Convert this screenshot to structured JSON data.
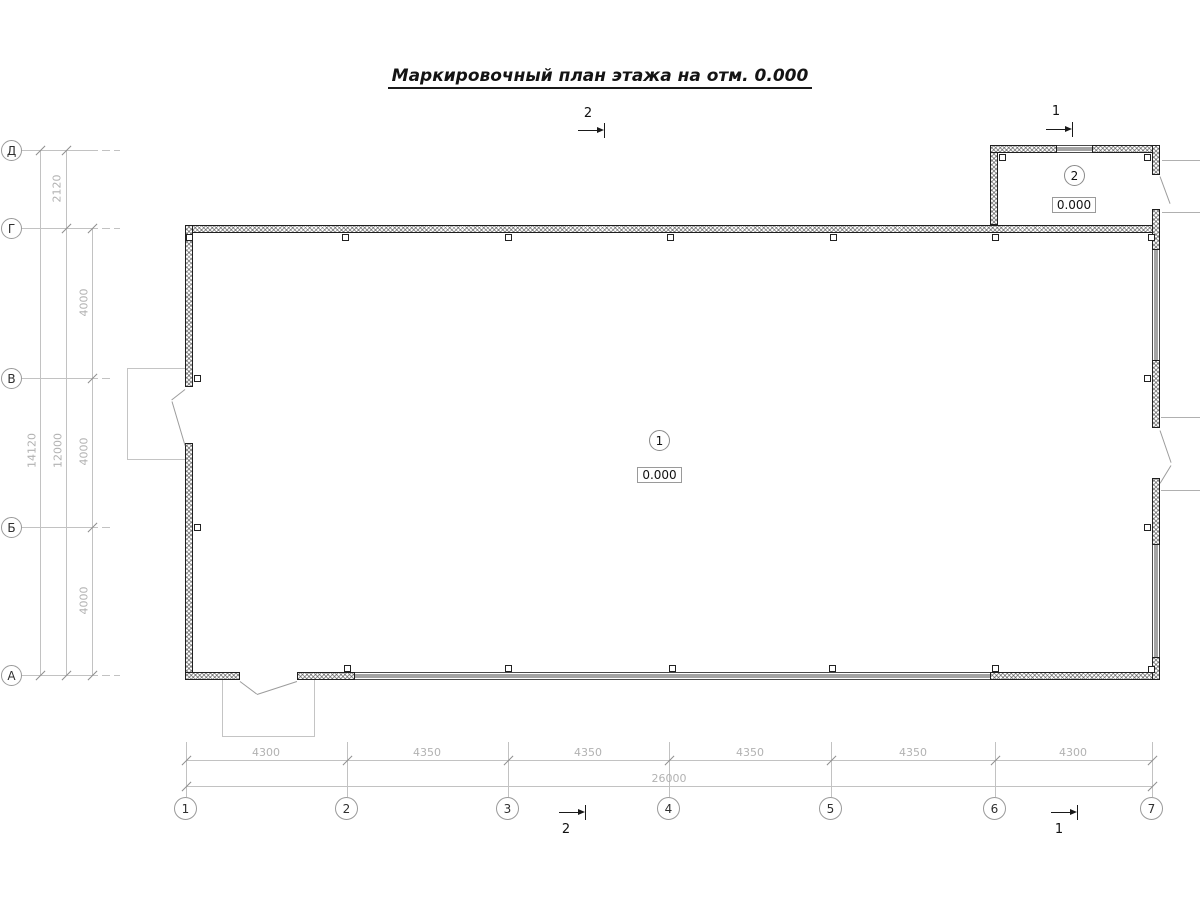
{
  "drawing": {
    "title": "Маркировочный план этажа на отм. 0.000"
  },
  "axis_rows": [
    {
      "label": "Д"
    },
    {
      "label": "Г"
    },
    {
      "label": "В"
    },
    {
      "label": "Б"
    },
    {
      "label": "А"
    }
  ],
  "axis_cols": [
    {
      "label": "1"
    },
    {
      "label": "2"
    },
    {
      "label": "3"
    },
    {
      "label": "4"
    },
    {
      "label": "5"
    },
    {
      "label": "6"
    },
    {
      "label": "7"
    }
  ],
  "dims_left": {
    "span_d_g": "2120",
    "span_g_v": "4000",
    "span_v_b": "4000",
    "span_b_a": "4000",
    "subtotal_g_a": "12000",
    "total_d_a": "14120"
  },
  "dims_bottom": {
    "span_1_2": "4300",
    "span_2_3": "4350",
    "span_3_4": "4350",
    "span_4_5": "4350",
    "span_5_6": "4350",
    "span_6_7": "4300",
    "total": "26000"
  },
  "rooms": [
    {
      "number": "1",
      "elevation": "0.000"
    },
    {
      "number": "2",
      "elevation": "0.000"
    }
  ],
  "section_marks": {
    "top_mid": "2",
    "top_right": "1",
    "bottom_mid": "2",
    "bottom_right": "1"
  },
  "colors": {
    "wall_line": "#1f1f1f",
    "dim_text": "#b2b2b2",
    "axis_text": "#2f2f2f",
    "label_text": "#111111"
  }
}
